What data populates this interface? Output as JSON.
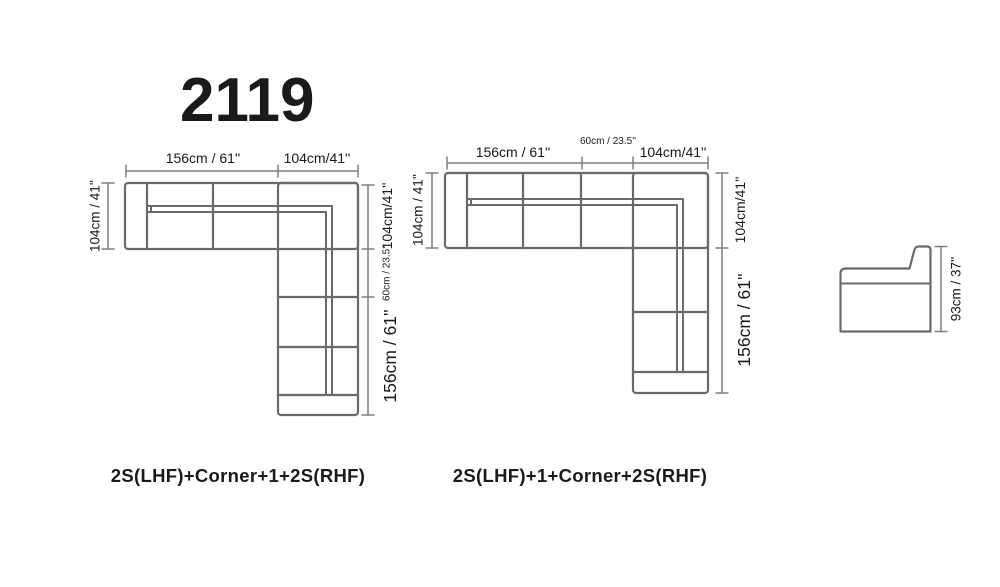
{
  "title": "2119",
  "colors": {
    "outline": "#6a6a6a",
    "dimension": "#7f7f7f",
    "text": "#1a1a1a",
    "title_text": "#000000",
    "background": "#ffffff"
  },
  "diagram_left": {
    "caption": "2S(LHF)+Corner+1+2S(RHF)",
    "dim_top_main": "156cm / 61''",
    "dim_top_corner": "104cm/41''",
    "dim_left_depth": "104cm / 41''",
    "dim_right_corner": "104cm/41''",
    "dim_right_single": "60cm / 23.5''",
    "dim_right_main": "156cm / 61''"
  },
  "diagram_right": {
    "caption": "2S(LHF)+1+Corner+2S(RHF)",
    "dim_top_main": "156cm / 61''",
    "dim_top_single": "60cm / 23.5''",
    "dim_top_corner": "104cm/41''",
    "dim_left_depth": "104cm / 41''",
    "dim_right_corner": "104cm/41''",
    "dim_right_main": "156cm / 61''"
  },
  "side_view": {
    "dim_height": "93cm / 37''"
  }
}
